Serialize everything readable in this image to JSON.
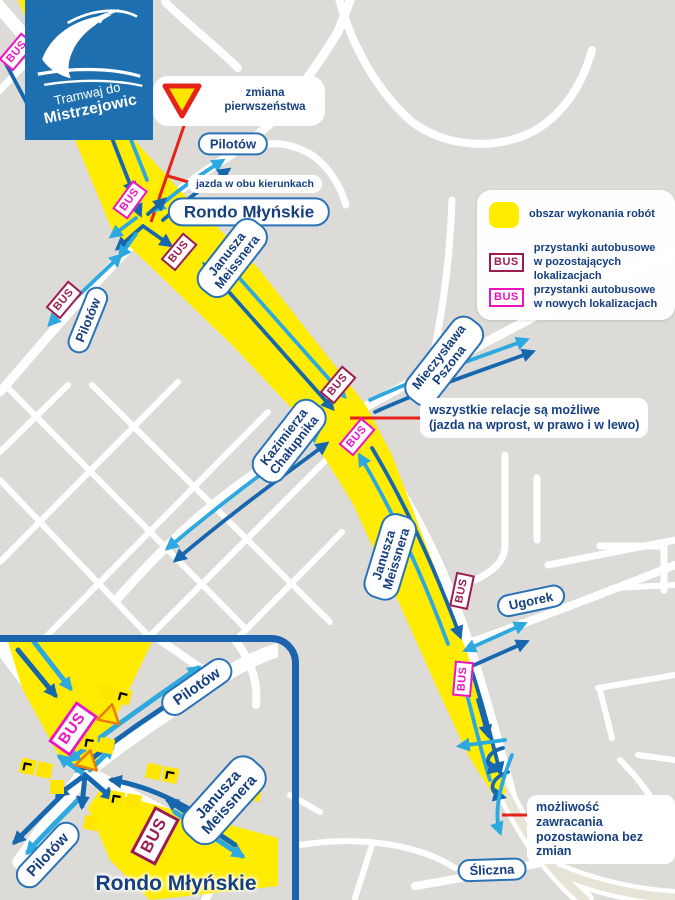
{
  "bus_label": "BUS",
  "logo": {
    "line1": "Tramwaj do",
    "line2": "Mistrzejowic"
  },
  "priority_sign": {
    "label": "zmiana\npierwszeństwa"
  },
  "legend": {
    "area": "obszar wykonania robót",
    "bus_existing": "przystanki autobusowe\nw pozostających lokalizacjach",
    "bus_new": "przystanki autobusowe\nw nowych lokalizacjach"
  },
  "annotations": {
    "both_directions": "jazda w obu kierunkach",
    "all_relations": "wszystkie relacje są możliwe\n(jazda na wprost, w prawo i w lewo)",
    "uturn": "możliwość zawracania\npozostawiona bez zmian"
  },
  "streets": {
    "pilotow_top": "Pilotów",
    "rondo": "Rondo Młyńskie",
    "meissnera_upper": "Janusza\nMeissnera",
    "pilotow_left": "Pilotów",
    "pszona": "Mieczysława\nPszona",
    "chalupnika": "Kazimierza\nChałupnika",
    "meissnera_lower": "Janusza\nMeissnera",
    "ugorek": "Ugorek",
    "sliczna": "Śliczna",
    "lakowa": "Łąkowa"
  },
  "inset": {
    "title": "Rondo Młyńskie",
    "pilotow_ne": "Pilotów",
    "meissnera": "Janusza\nMeissnera",
    "pilotow_sw": "Pilotów"
  },
  "colors": {
    "work_area": "#ffec00",
    "bus_existing": "#9c1b51",
    "bus_new": "#ee13c1",
    "arrow_dark": "#1667ae",
    "arrow_light": "#2ea9e0",
    "accent_red": "#e5231b",
    "label_blue": "#153f7f",
    "logo_blue": "#1e6fb0"
  }
}
